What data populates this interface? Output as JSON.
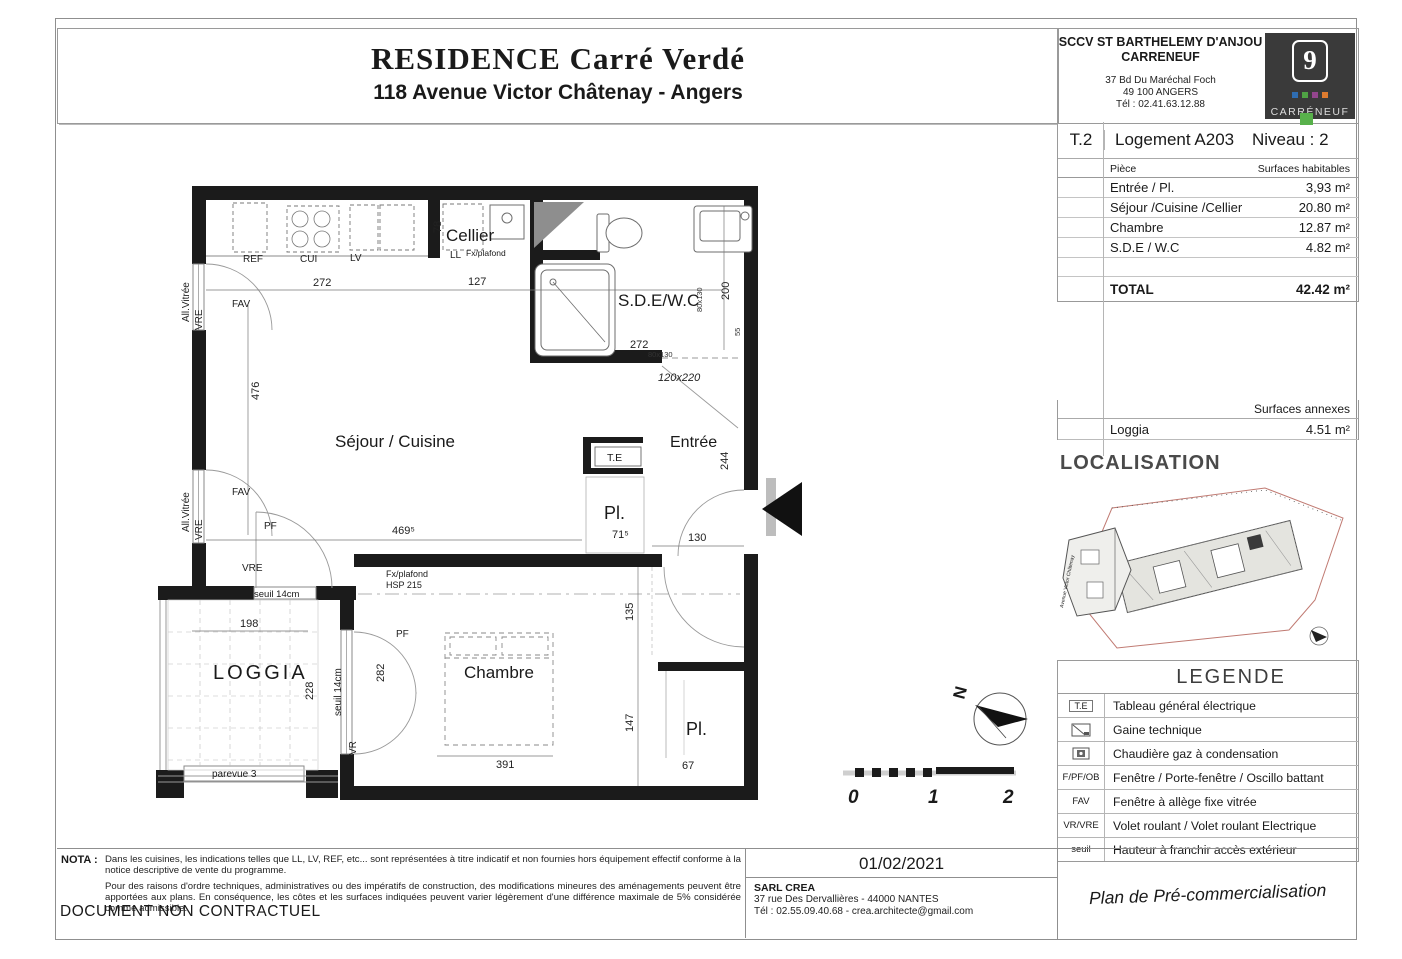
{
  "title_block": {
    "title": "RESIDENCE Carré Verdé",
    "subtitle": "118 Avenue Victor Châtenay - Angers"
  },
  "developer": {
    "name1": "SCCV ST BARTHELEMY D'ANJOU",
    "name2": "CARRENEUF",
    "address1": "37 Bd Du Maréchal Foch",
    "address2": "49 100 ANGERS",
    "phone": "Tél : 02.41.63.12.88",
    "logo": {
      "number": "9",
      "brand": "CARRÉNEUF",
      "dark_bg": "#3a3a3a",
      "dot_colors": [
        "#2f6db2",
        "#4fa344",
        "#93458d",
        "#dd7b2f"
      ],
      "green_accent": "#58b14b"
    }
  },
  "unit_header": {
    "type": "T.2",
    "name": "Logement A203",
    "level": "Niveau : 2"
  },
  "surfaces": {
    "col_room": "Pièce",
    "col_area": "Surfaces habitables",
    "rows": [
      {
        "room": "Entrée / Pl.",
        "area": "3,93 m²"
      },
      {
        "room": "Séjour /Cuisine /Cellier",
        "area": "20.80 m²"
      },
      {
        "room": "Chambre",
        "area": "12.87 m²"
      },
      {
        "room": "S.D.E / W.C",
        "area": "4.82 m²"
      }
    ],
    "total_label": "TOTAL",
    "total_area": "42.42 m²"
  },
  "annexes": {
    "header": "Surfaces annexes",
    "rows": [
      {
        "room": "Loggia",
        "area": "4.51 m²"
      }
    ]
  },
  "localisation": {
    "heading": "LOCALISATION",
    "street": "Avenue Victor Châtenay"
  },
  "legende": {
    "heading": "LEGENDE",
    "rows": [
      {
        "symbol": "T.E",
        "label": "Tableau général électrique"
      },
      {
        "symbol": "",
        "label": "Gaine technique"
      },
      {
        "symbol": "",
        "label": "Chaudière gaz à condensation"
      },
      {
        "symbol": "F/PF/OB",
        "label": "Fenêtre / Porte-fenêtre / Oscillo battant"
      },
      {
        "symbol": "FAV",
        "label": "Fenêtre à allège fixe vitrée"
      },
      {
        "symbol": "VR/VRE",
        "label": "Volet roulant / Volet roulant Electrique"
      },
      {
        "symbol": "seuil",
        "label": "Hauteur à franchir accès extérieur"
      }
    ]
  },
  "footer": {
    "nota_label": "NOTA :",
    "nota_p1": "Dans les cuisines, les indications telles que LL, LV, REF, etc... sont représentées à titre indicatif et non fournies hors équipement effectif conforme à la notice descriptive de vente du programme.",
    "nota_p2": "Pour des raisons d'ordre techniques, administratives ou des impératifs de construction, des modifications mineures des aménagements peuvent être apportées aux plans. En conséquence, les côtes et les surfaces indiquées peuvent varier légèrement d'une différence maximale de 5% considérée comme admissible.",
    "non_contractual": "DOCUMENT NON CONTRACTUEL",
    "date": "01/02/2021",
    "architect_name": "SARL CREA",
    "architect_address": "37 rue Des Dervallières - 44000 NANTES",
    "architect_contact": "Tél : 02.55.09.40.68 - crea.architecte@gmail.com",
    "plan_title": "Plan de Pré-commercialisation"
  },
  "floorplan": {
    "rooms": {
      "sejour": "Séjour / Cuisine",
      "cellier": "Cellier",
      "sde": "S.D.E/W.C",
      "entree": "Entrée",
      "chambre": "Chambre",
      "loggia": "LOGGIA",
      "pl_entree": "Pl.",
      "pl_chambre": "Pl.",
      "te": "T.E"
    },
    "fixtures": {
      "ref": "REF",
      "cui": "CUI",
      "lv": "LV",
      "ll": "LL"
    },
    "ann": {
      "all_vitree": "All.Vitrée",
      "vre": "VRE",
      "fav": "FAV",
      "pf": "PF",
      "vr": "VR",
      "seuil14": "seuil 14cm",
      "parevue": "parevue 3",
      "fx_plafond": "Fx/plafond",
      "hsp215": "HSP 215"
    },
    "dims": {
      "top_sejour": "272",
      "top_cellier": "127",
      "cellier_h": "78",
      "sde_h": "200",
      "sde_w": "272",
      "shower": "80x130",
      "sde_gap": "55",
      "door_sde": "120x220",
      "sejour_h": "476",
      "sejour_w": "469⁵",
      "pl_w": "71⁵",
      "entree_h": "244",
      "entree_w": "130",
      "loggia_w": "198",
      "loggia_h": "228",
      "chambre_left": "282",
      "chambre_r1": "135",
      "chambre_r2": "147",
      "chambre_w": "391",
      "pl2_w": "67"
    },
    "compass_n": "N",
    "scale": {
      "s0": "0",
      "s1": "1",
      "s2": "2"
    }
  }
}
